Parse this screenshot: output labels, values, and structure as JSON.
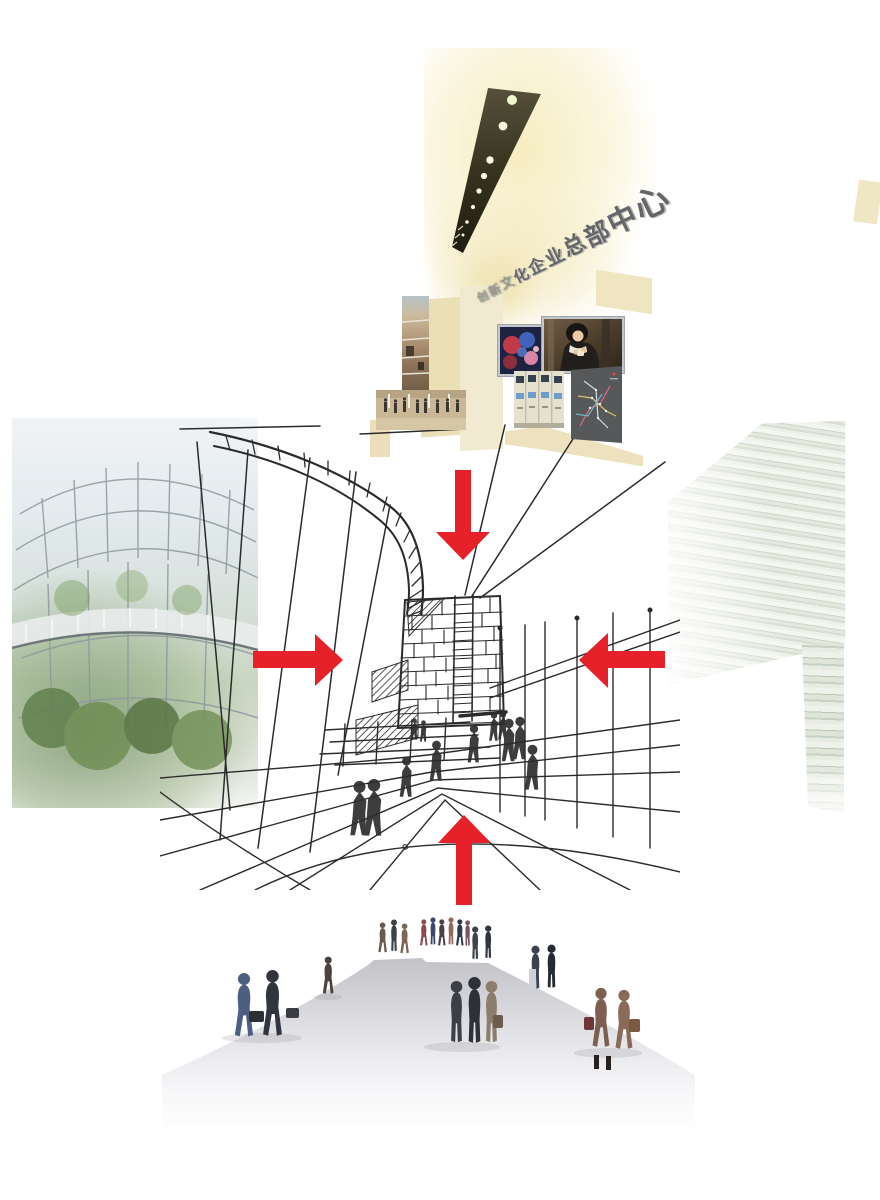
{
  "page": {
    "width": 880,
    "height": 1200,
    "background": "#ffffff"
  },
  "title": {
    "text": "创新文化企业总部中心",
    "style": "3d-gray-perspective-signage"
  },
  "colors": {
    "arrow_red": "#e62129",
    "wall_cream": "#ebdfb6",
    "ceiling_glow": "#f6ecc2",
    "stone_wall": "#dde4d6",
    "sketch_ink": "#2b2b2b",
    "mound_gray": "#c5c5c9",
    "frame_silver": "#c3c7cb"
  },
  "arrows": [
    {
      "name": "arrow-top",
      "direction": "down"
    },
    {
      "name": "arrow-left",
      "direction": "right"
    },
    {
      "name": "arrow-right",
      "direction": "left"
    },
    {
      "name": "arrow-bottom",
      "direction": "up"
    }
  ],
  "photos": {
    "ceiling": {
      "name": "ceiling-light-beam-photo"
    },
    "mall": {
      "name": "mall-atrium-collage"
    },
    "screen": {
      "name": "media-art-screen-photo"
    },
    "woman": {
      "name": "woman-tea-photo"
    },
    "kiosks": {
      "name": "ticket-kiosks-photo"
    },
    "map": {
      "name": "metro-map-panel"
    },
    "atrium": {
      "name": "glass-atrium-photo"
    },
    "stone_upper": {
      "name": "stone-wall-photo"
    },
    "stone_lower": {
      "name": "stone-wall-column-photo"
    },
    "plaza": {
      "name": "plaza-people-cutouts"
    }
  },
  "sketch": {
    "name": "concept-perspective-sketch",
    "elements": [
      "arched-canopy-ladder",
      "masonry-tower",
      "hatched-panels",
      "pedestrian-figures",
      "perspective-ground-lines",
      "fence-posts"
    ]
  }
}
